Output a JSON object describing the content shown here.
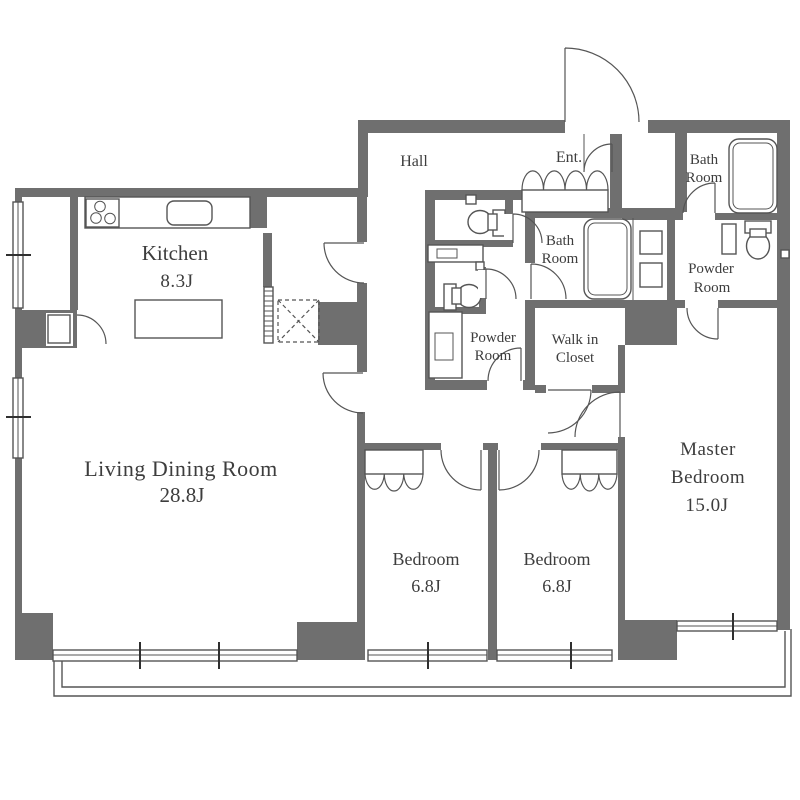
{
  "rooms": {
    "kitchen": {
      "name": "Kitchen",
      "area": "8.3J"
    },
    "living_dining_room": {
      "name": "Living Dining Room",
      "area": "28.8J"
    },
    "hall": {
      "name": "Hall"
    },
    "entrance": {
      "name": "Ent."
    },
    "bathroom_upper": {
      "name_line1": "Bath",
      "name_line2": "Room"
    },
    "bathroom_inner": {
      "name_line1": "Bath",
      "name_line2": "Room"
    },
    "powder_room_right": {
      "name_line1": "Powder",
      "name_line2": "Room"
    },
    "powder_room_center": {
      "name_line1": "Powder",
      "name_line2": "Room"
    },
    "walk_in_closet": {
      "name_line1": "Walk in",
      "name_line2": "Closet"
    },
    "master_bedroom": {
      "name_line1": "Master",
      "name_line2": "Bedroom",
      "area": "15.0J"
    },
    "bedroom_left": {
      "name": "Bedroom",
      "area": "6.8J"
    },
    "bedroom_right": {
      "name": "Bedroom",
      "area": "6.8J"
    }
  },
  "fixtures": [
    "gas-stove",
    "kitchen-sink",
    "kitchen-island",
    "refrigerator-space",
    "bathtub",
    "toilet",
    "washbasin",
    "washer-dryer-space",
    "shoe-cabinet",
    "folding-closet-door",
    "entrance-door",
    "interior-door",
    "sliding-window",
    "balcony"
  ],
  "colors": {
    "wall": "#6f6f6f",
    "thin_line": "#555555",
    "label_text": "#3d3d3d",
    "background": "#ffffff"
  }
}
